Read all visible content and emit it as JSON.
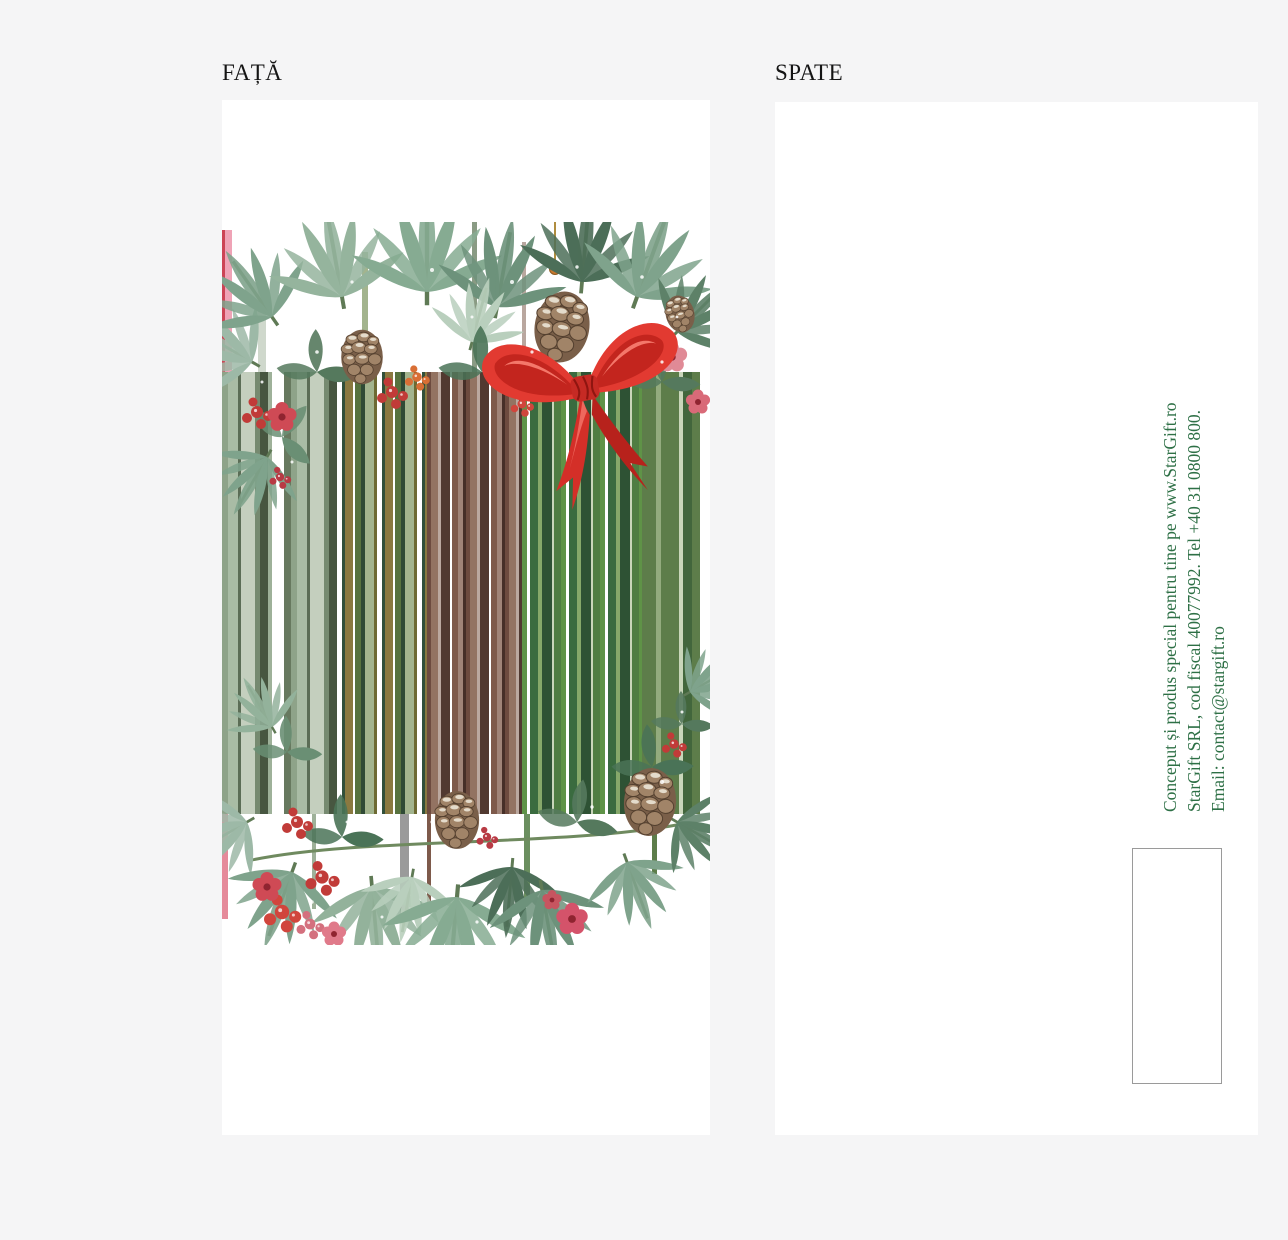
{
  "labels": {
    "front": "FAȚĂ",
    "back": "SPATE"
  },
  "back_card": {
    "vertical_text": {
      "color": "#2e7046",
      "line1": "Conceput și produs special pentru tine pe www.StarGift.ro",
      "line2": "StarGift SRL, cod fiscal 40077992. Tel +40 31 0800 800.",
      "line3": "Email: contact@stargift.ro"
    },
    "barcode_box": {
      "note": ""
    }
  },
  "front_design": {
    "palette": {
      "bow_red": "#e23a31",
      "bow_shadow": "#a81d18",
      "berry_red": "#c13b38",
      "berry_orange": "#d96f35",
      "flower_pink": "#e08a96",
      "pine_frost": "#8fae97",
      "pine_dark": "#4c6e58",
      "cone_brown": "#8a6f55"
    },
    "stripe_segments": [
      {
        "x": 0,
        "w": 115,
        "y": 150,
        "h": 442,
        "widths": [
          6,
          10,
          3,
          14,
          5,
          8,
          4,
          12,
          7
        ],
        "colors": [
          "#8ea389",
          "#a9bca5",
          "#5b6d56",
          "#c4cfbe",
          "#768a70",
          "#475640",
          "#9eb199",
          "#ffffff",
          "#67795f"
        ]
      },
      {
        "x": 115,
        "w": 90,
        "y": 150,
        "h": 442,
        "widths": [
          5,
          3,
          8,
          2,
          6,
          4,
          9,
          3
        ],
        "colors": [
          "#ffffff",
          "#31503a",
          "#8a7940",
          "#ffffff",
          "#57723f",
          "#2f4a35",
          "#a3b48e",
          "#6d6a33"
        ]
      },
      {
        "x": 205,
        "w": 95,
        "y": 150,
        "h": 442,
        "widths": [
          4,
          7,
          3,
          9,
          2,
          6,
          5,
          3
        ],
        "colors": [
          "#6d4b3f",
          "#937362",
          "#bba89f",
          "#513930",
          "#ffffff",
          "#7e5a4b",
          "#a08478",
          "#462f28"
        ]
      },
      {
        "x": 300,
        "w": 120,
        "y": 150,
        "h": 442,
        "widths": [
          5,
          3,
          8,
          4,
          10,
          2,
          7
        ],
        "colors": [
          "#5f9347",
          "#ffffff",
          "#3a6b3f",
          "#86a86a",
          "#2e5234",
          "#c9d6ba",
          "#4f7d42"
        ]
      },
      {
        "x": 420,
        "w": 68,
        "y": 150,
        "h": 442,
        "widths": [
          14,
          5,
          18,
          4,
          9,
          8,
          10
        ],
        "colors": [
          "#5d7d4a",
          "#93ab7e",
          "#5d7d4a",
          "#c9d6ba",
          "#42663c",
          "#5d7d4a",
          "#ffffff"
        ]
      }
    ],
    "streaks": [
      {
        "x": 0,
        "w": 3,
        "y": 8,
        "h": 142,
        "color": "#cc4455"
      },
      {
        "x": 3,
        "w": 7,
        "y": 8,
        "h": 142,
        "color": "#efa3b6"
      },
      {
        "x": 36,
        "w": 8,
        "y": 60,
        "h": 90,
        "color": "#cfd8cc"
      },
      {
        "x": 250,
        "w": 5,
        "y": 0,
        "h": 150,
        "color": "#8a9b84"
      },
      {
        "x": 300,
        "w": 4,
        "y": 20,
        "h": 130,
        "color": "#b9a79f"
      },
      {
        "x": 140,
        "w": 6,
        "y": 30,
        "h": 120,
        "color": "#a3b48e"
      },
      {
        "x": 0,
        "w": 6,
        "y": 592,
        "h": 105,
        "color": "#e58a9a"
      },
      {
        "x": 90,
        "w": 4,
        "y": 592,
        "h": 95,
        "color": "#9eb199"
      },
      {
        "x": 178,
        "w": 9,
        "y": 592,
        "h": 108,
        "color": "#9a9a9a"
      },
      {
        "x": 205,
        "w": 4,
        "y": 592,
        "h": 95,
        "color": "#7e5a4b"
      },
      {
        "x": 302,
        "w": 6,
        "y": 592,
        "h": 88,
        "color": "#6b8f5f"
      },
      {
        "x": 430,
        "w": 5,
        "y": 592,
        "h": 60,
        "color": "#5d7d4a"
      }
    ]
  }
}
